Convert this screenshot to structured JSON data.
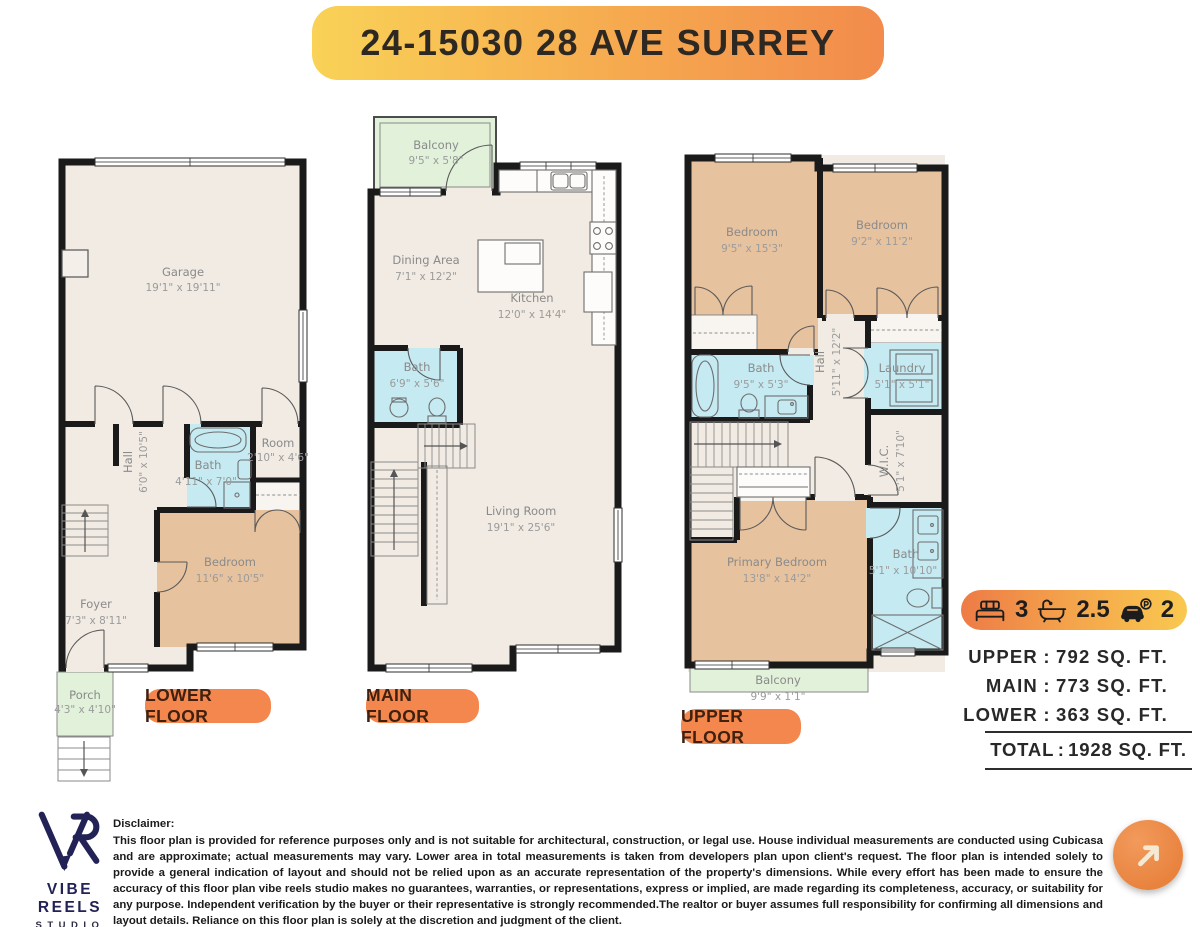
{
  "title": "24-15030 28 AVE SURREY",
  "floors": {
    "lower": {
      "label": "LOWER FLOOR",
      "rooms": [
        {
          "name": "Garage",
          "dims": "19'1\" x 19'11\""
        },
        {
          "name": "Hall",
          "dims": "6'0\" x 10'5\""
        },
        {
          "name": "Bath",
          "dims": "4'11\" x 7'0\""
        },
        {
          "name": "Room",
          "dims": "2'10\" x 4'6\""
        },
        {
          "name": "Bedroom",
          "dims": "11'6\" x 10'5\""
        },
        {
          "name": "Foyer",
          "dims": "7'3\" x 8'11\""
        },
        {
          "name": "Porch",
          "dims": "4'3\" x 4'10\""
        }
      ]
    },
    "main": {
      "label": "MAIN FLOOR",
      "rooms": [
        {
          "name": "Balcony",
          "dims": "9'5\" x 5'8\""
        },
        {
          "name": "Dining Area",
          "dims": "7'1\" x 12'2\""
        },
        {
          "name": "Kitchen",
          "dims": "12'0\" x 14'4\""
        },
        {
          "name": "Bath",
          "dims": "6'9\" x 5'6\""
        },
        {
          "name": "Living Room",
          "dims": "19'1\" x 25'6\""
        }
      ]
    },
    "upper": {
      "label": "UPPER FLOOR",
      "rooms": [
        {
          "name": "Bedroom",
          "dims": "9'5\" x 15'3\""
        },
        {
          "name": "Bedroom",
          "dims": "9'2\" x 11'2\""
        },
        {
          "name": "Bath",
          "dims": "9'5\" x 5'3\""
        },
        {
          "name": "Hall",
          "dims": "5'11\" x 12'2\""
        },
        {
          "name": "Laundry",
          "dims": "5'1\" x 5'1\""
        },
        {
          "name": "W.I.C.",
          "dims": "5'1\" x 7'10\""
        },
        {
          "name": "Primary Bedroom",
          "dims": "13'8\" x 14'2\""
        },
        {
          "name": "Bath",
          "dims": "5'1\" x 10'10\""
        },
        {
          "name": "Balcony",
          "dims": "9'9\" x 1'1\""
        }
      ]
    }
  },
  "stats": {
    "beds": {
      "icon": "bed-icon",
      "value": "3"
    },
    "baths": {
      "icon": "bathtub-icon",
      "value": "2.5"
    },
    "parking": {
      "icon": "car-parking-icon",
      "value": "2"
    }
  },
  "areas": {
    "separator": ":",
    "rows": [
      {
        "label": "UPPER",
        "value": "792 SQ. FT."
      },
      {
        "label": "MAIN",
        "value": "773 SQ. FT."
      },
      {
        "label": "LOWER",
        "value": "363 SQ. FT."
      }
    ],
    "total": {
      "label": "TOTAL",
      "value": "1928 SQ. FT."
    }
  },
  "footer": {
    "brand_name": "VIBE REELS",
    "brand_sub": "STUDIO",
    "disclaimer_heading": "Disclaimer:",
    "disclaimer_body": "This floor plan is provided for reference purposes only and is not suitable for architectural, construction, or legal use. House individual measurements are conducted using Cubicasa and are approximate; actual measurements may vary. Lower area in total measurements is taken from developers plan upon client's request. The floor plan is intended solely to provide a general indication of layout and should not be relied upon as an accurate representation of the property's dimensions. While every effort has been made to ensure the accuracy of this floor plan vibe reels studio makes no guarantees, warranties, or representations, express or implied, are made regarding its completeness, accuracy, or suitability for any purpose. Independent verification by the buyer or their representative is strongly recommended.The realtor or buyer assumes full responsibility for confirming all dimensions and layout details. Reliance on this floor plan is solely at the discretion and judgment of the client."
  },
  "colors": {
    "banner_gradient_start": "#F9D257",
    "banner_gradient_end": "#F28B4C",
    "floor_pill": "#F3874E",
    "stats_gradient_start": "#ED7B46",
    "stats_gradient_end": "#F9C84F",
    "wall": "#1A1A1A",
    "room_beige": "#F1EBE3",
    "room_tan": "#E7C29E",
    "room_blue": "#C5EAF2",
    "room_green": "#E1F1DA",
    "logo_navy": "#232256",
    "cta_orange": "#E8823D"
  }
}
